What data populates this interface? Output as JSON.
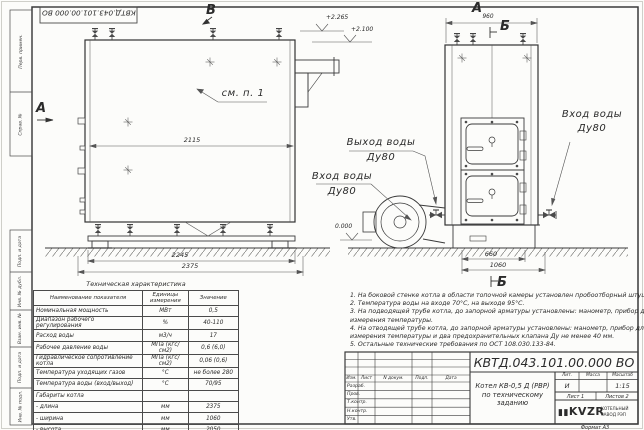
{
  "sheet": {
    "top_doc_number": "КВТД.043.101.00.000 ВО",
    "format": "Формат А3"
  },
  "frame": {
    "labels": {
      "perv": "Перв. примен.",
      "sprav": "Справ. №",
      "podp1": "Подп. и дата",
      "inv_dubl": "Инв. № дубл.",
      "vzam": "Взам. инв. №",
      "podp2": "Подп. и дата",
      "inv_podl": "Инв. № подл."
    }
  },
  "views": {
    "left": {
      "view_b": "В",
      "view_a": "А",
      "see_note": "см. п. 1",
      "dim_2115": "2115",
      "dim_2245": "2245",
      "dim_2375": "2375",
      "elev_top": "+2.265",
      "elev_mid": "+2.100",
      "elev_zero": "0.000"
    },
    "right": {
      "view_a": "А",
      "dim_960": "960",
      "view_b": "Б",
      "dim_660": "660",
      "dim_1060": "1060",
      "view_b_bottom": "Б"
    },
    "callouts": {
      "outlet_line1": "Выход воды",
      "outlet_line2": "Ду80",
      "inlet_mid_line1": "Вход воды",
      "inlet_mid_line2": "Ду80",
      "inlet_right_line1": "Вход воды",
      "inlet_right_line2": "Ду80"
    }
  },
  "spec_table": {
    "title": "Техническая характеристика",
    "col_name": "Наименование показателя",
    "col_units": "Единицы измерения",
    "col_value": "Значение",
    "rows": [
      [
        "Номинальная мощность",
        "МВт",
        "0,5"
      ],
      [
        "Диапазон рабочего регулирования",
        "%",
        "40-110"
      ],
      [
        "Расход воды",
        "м3/ч",
        "17"
      ],
      [
        "Рабочее давление воды",
        "МПа (кгс/см2)",
        "0,6 (6,0)"
      ],
      [
        "Гидравлическое сопротивление котла",
        "МПа (кгс/см2)",
        "0,06 (0,6)"
      ],
      [
        "Температура уходящих газов",
        "°С",
        "не более 280"
      ],
      [
        "Температура воды (вход/выход)",
        "°С",
        "70/95"
      ],
      [
        "Габариты котла",
        "",
        ""
      ],
      [
        "- длина",
        "мм",
        "2375"
      ],
      [
        "- ширина",
        "мм",
        "1060"
      ],
      [
        "- высота",
        "мм",
        "2050"
      ]
    ]
  },
  "notes": {
    "lines": [
      "1. На боковой стенке котла в области топочной камеры установлен пробоотборный штуцер",
      "2. Температура воды на входе 70°С, на выходе 95°С.",
      "3. На подводящей трубе котла, до запорной арматуры установлены: манометр, прибор для",
      "измерения температуры.",
      "4. На отводящей трубе котла, до запорной арматуры установлены: манометр, прибор для",
      "измерения температуры и два предохранительных клапана Ду не менее 40 мм.",
      "5. Остальные технические требования по ОСТ 108.030.133-84."
    ]
  },
  "title_block": {
    "doc_number": "КВТД.043.101.00.000 ВО",
    "title_line1": "Котел КВ-0,5 Д (РВР)",
    "title_line2": "по техническому заданию",
    "col_izm": "Изм.",
    "col_list": "Лист",
    "col_ndoc": "N докум.",
    "col_podp": "Подп.",
    "col_data": "Дата",
    "row_razrab": "Разраб.",
    "row_prov": "Пров.",
    "row_tkontr": "Т.контр.",
    "row_nkontr": "Н.контр.",
    "row_utv": "Утв.",
    "lit_header": "Лит.",
    "massa_header": "Масса",
    "masshtab_header": "Масштаб",
    "lit_value": "И",
    "masshtab_value": "1:15",
    "list_label": "Лист 1",
    "listov_label": "Листов 2",
    "logo_mark": "▮▮",
    "logo_text": "KVZR",
    "logo_sub1": "КОТЕЛЬНЫЙ",
    "logo_sub2": "ЗАВОД РЭП"
  }
}
